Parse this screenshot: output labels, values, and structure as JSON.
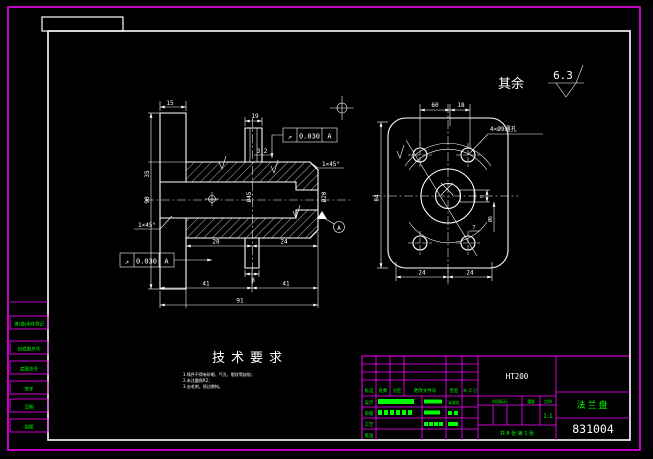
{
  "colors": {
    "line": "#ffffff",
    "border": "#ff00ff",
    "table_text": "#00ff00"
  },
  "surface_note": {
    "label": "其余",
    "value": "6.3"
  },
  "tech": {
    "title": "技术要求",
    "lines": [
      "1.铸件不得有砂眼、气孔、裂纹等缺陷；",
      "2.未注圆角R2；",
      "3.去毛刺，锐边倒钝。"
    ]
  },
  "views": {
    "left": {
      "d15": "15",
      "d19": "19",
      "d35": "35",
      "d90": "90",
      "dia45": "Ø45",
      "dia20": "Ø20",
      "d28": "28",
      "d24": "24",
      "d8": "8",
      "d41a": "41",
      "d41b": "41",
      "d91": "91",
      "rough": "3.2",
      "chamfer_top": "1×45°",
      "chamfer_left": "1×45°",
      "datum": "A",
      "tol_top": {
        "sym": "↗",
        "val": "0.030",
        "datum": "A"
      },
      "tol_bot": {
        "sym": "↗",
        "val": "0.030",
        "datum": "A"
      }
    },
    "right": {
      "d60": "60",
      "d18": "18",
      "d84": "84",
      "d24a": "24",
      "d24b": "24",
      "d9": "9",
      "d7": "7",
      "dia6": "Ø6",
      "holes_note": "4×Ø9通孔"
    }
  },
  "margin": {
    "labels": [
      "借(通)用件登记",
      "旧底图总号",
      "底图总号",
      "签字",
      "日期",
      "描图"
    ]
  },
  "tb": {
    "material": "HT200",
    "part_name": "法兰盘",
    "drawing_no": "831004",
    "scale_label": "比例",
    "scale": "1:1",
    "weight_label": "重量",
    "stage_label": "阶段标记",
    "sheets": "共 8 张 第 1 张",
    "rev_headers": [
      "标记",
      "处数",
      "分区",
      "更改文件号",
      "签名",
      "年 月 日"
    ],
    "roles": [
      "设计",
      "审核",
      "工艺",
      "批准"
    ],
    "std": "标准化"
  }
}
